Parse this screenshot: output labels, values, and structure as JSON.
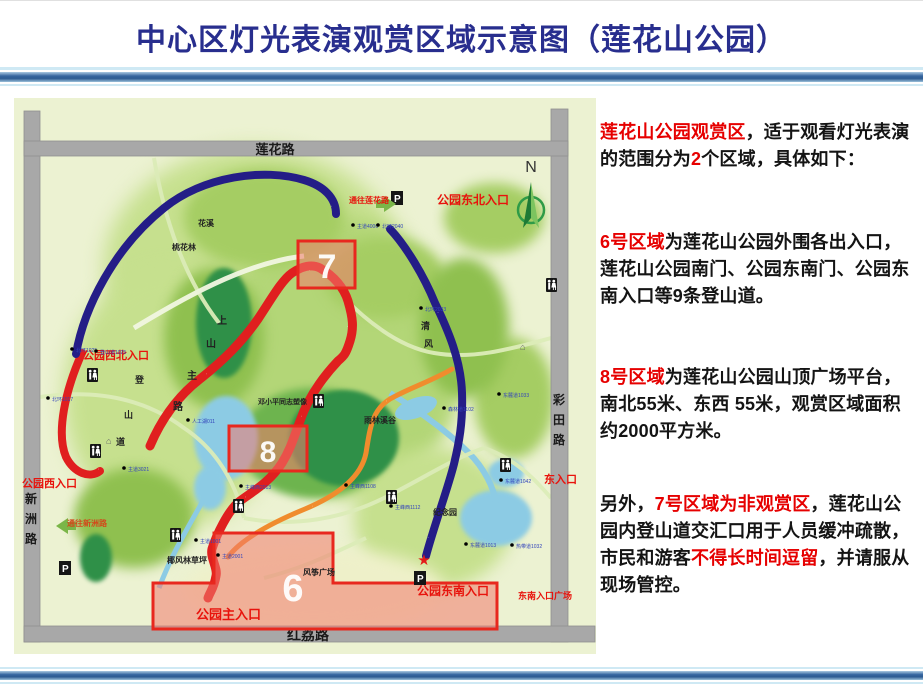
{
  "slide": {
    "title": "中心区灯光表演观赏区域示意图（莲花山公园）"
  },
  "colors": {
    "title_blue": "#282e8e",
    "accent_red": "#e60000",
    "zone_fill": "#f37a6e",
    "zone_border": "#e8281e",
    "navy_route": "#241d87",
    "red_route": "#e01f1f",
    "orange_route": "#f08c2d"
  },
  "right_panel": {
    "p1": {
      "s1": "莲花山公园观赏区",
      "s2": "，适于观看灯光表演的范围分为",
      "s3": "2",
      "s4": "个区域，具体如下："
    },
    "p2": {
      "s1": "6号区域",
      "s2": "为莲花山公园外围各出入口，莲花山公园南门、公园东南门、公园东南入口等9条登山道。"
    },
    "p3": {
      "s1": "8号区域",
      "s2": "为莲花山公园山顶广场平台，南北55米、东西 55米，观赏区域面积约2000平方米。"
    },
    "p4": {
      "s1": "另外，",
      "s2": "7号区域为非观赏区",
      "s3": "，莲花山公园内登山道交汇口用于人员缓冲疏散，市民和游客",
      "s4": "不得长时间逗留",
      "s5": "，并请服从现场管控。"
    }
  },
  "map": {
    "roads": {
      "top": "莲花路",
      "bottom": "红荔路",
      "left_chars": [
        "新",
        "洲",
        "路"
      ],
      "right_chars": [
        "彩",
        "田",
        "路"
      ]
    },
    "compass_n": "N",
    "zones": {
      "z6": "6",
      "z7": "7",
      "z8": "8"
    },
    "entrances": {
      "northwest": "公园西北入口",
      "west": "公园西入口",
      "northeast": "公园东北入口",
      "east": "东入口",
      "southeast": "公园东南入口",
      "southeast_plaza": "东南入口广场",
      "main": "公园主入口",
      "to_lianhua_road": "通往莲花路",
      "to_xinzhou_road": "通往新洲路"
    },
    "places": {
      "huaxi": "花溪",
      "taohualin": "桃花林",
      "deng_statue": "邓小平同志塑像",
      "rainforest_valley": "雨林溪谷",
      "kite_plaza": "风筝广场",
      "coconut_lawn": "椰风林草坪",
      "memorial_garden": "纪念园",
      "qingfeng_chars": [
        "清",
        "风"
      ],
      "uphill_chars": [
        "上",
        "山",
        "主",
        "路"
      ],
      "trail_chars": [
        "登",
        "山",
        "道"
      ]
    },
    "icons": {
      "parking": "P",
      "star": "★",
      "pavilion": "⌂"
    },
    "markers": [
      "北环1025",
      "北环1017",
      "登山道1025",
      "主道4006",
      "北环2040",
      "北环2033",
      "东麓道1033",
      "东麓道1042",
      "热带道1032",
      "东麓道1013",
      "人工湖011",
      "主峰西2013",
      "主峰西1108",
      "主峰西1112",
      "森林道1102",
      "主道3021",
      "主道2001",
      "主道1001"
    ]
  }
}
